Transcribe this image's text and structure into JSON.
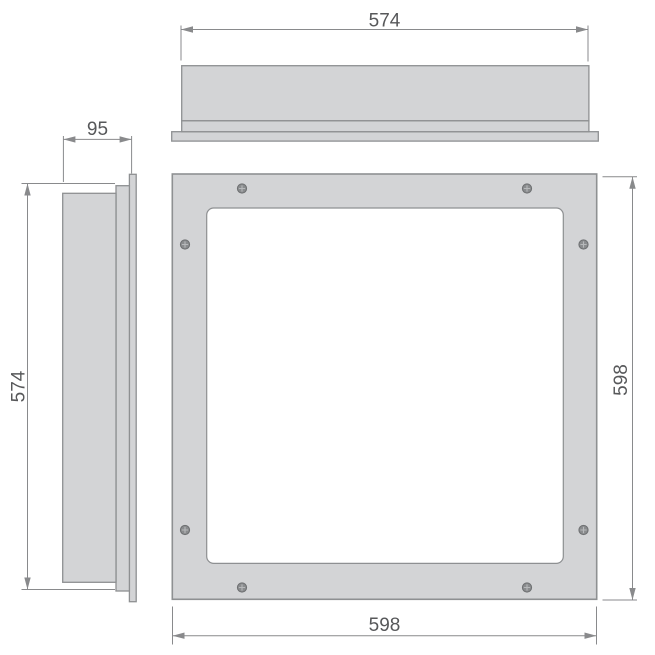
{
  "dimensions": {
    "top_width": "574",
    "side_depth": "95",
    "side_height": "574",
    "front_height": "598",
    "front_width": "598"
  },
  "front_view": {
    "screw_count": 8
  },
  "colors": {
    "panel_fill": "#d3d4d6",
    "panel_stroke": "#8e9092",
    "dimension_line": "#898a8c",
    "dimension_text": "#57585a",
    "screw_fill": "#8a8c8e",
    "screw_stroke": "#6d6f71",
    "screw_cross": "#b7b9bb",
    "background": "#ffffff"
  }
}
